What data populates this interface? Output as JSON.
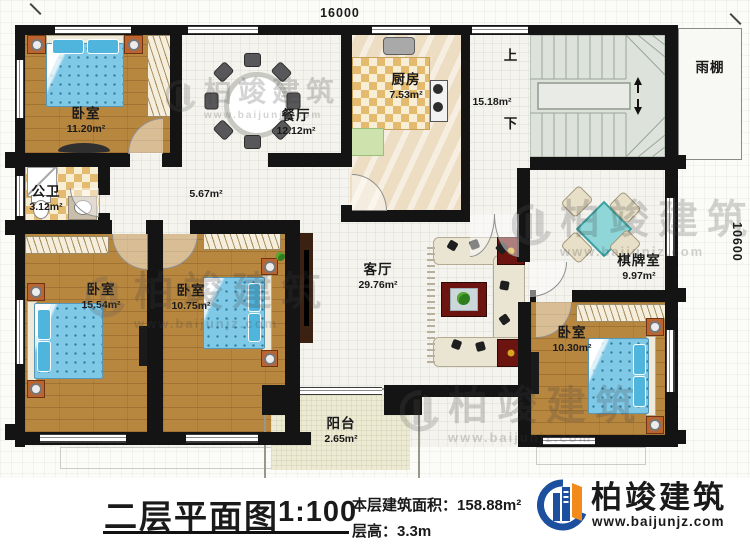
{
  "titleblock": {
    "title": "二层平面图",
    "scale": "1:100",
    "area_label": "本层建筑面积：",
    "area_value": "158.88m²",
    "height_label": "层高：",
    "height_value": "3.3m"
  },
  "brand": {
    "name": "柏竣建筑",
    "url": "www.baijunjz.com"
  },
  "watermark": {
    "name": "柏竣建筑",
    "url": "www.baijunjz.com"
  },
  "dims": {
    "width": "16000",
    "height": "10600"
  },
  "stairs": {
    "up": "上",
    "down": "下"
  },
  "rooms": {
    "bedroom_tl": {
      "name": "卧室",
      "area": "11.20m²"
    },
    "dining": {
      "name": "餐厅",
      "area": "12.12m²"
    },
    "kitchen": {
      "name": "厨房",
      "area": "7.53m²"
    },
    "stair_hall": {
      "area": "15.18m²"
    },
    "canopy": {
      "name": "雨棚"
    },
    "bathroom": {
      "name": "公卫",
      "area": "3.12m²"
    },
    "hallway": {
      "area": "5.67m²"
    },
    "bedroom_bl": {
      "name": "卧室",
      "area": "15.54m²"
    },
    "bedroom_mid": {
      "name": "卧室",
      "area": "10.75m²"
    },
    "living": {
      "name": "客厅",
      "area": "29.76m²"
    },
    "chess": {
      "name": "棋牌室",
      "area": "9.97m²"
    },
    "bedroom_br": {
      "name": "卧室",
      "area": "10.30m²"
    },
    "balcony": {
      "name": "阳台",
      "area": "2.65m²"
    }
  }
}
